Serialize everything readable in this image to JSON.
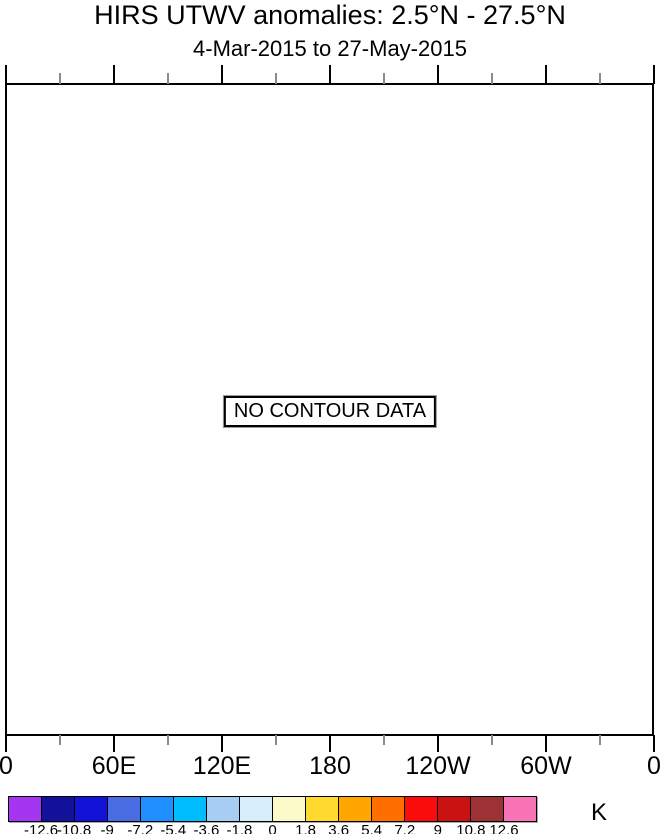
{
  "chart_data": {
    "type": "heatmap",
    "title": "HIRS UTWV anomalies: 2.5°N - 27.5°N",
    "subtitle": "4-Mar-2015 to 27-May-2015",
    "status_message": "NO CONTOUR DATA",
    "values": [],
    "x_axis": {
      "tick_labels": [
        "0",
        "60E",
        "120E",
        "180",
        "120W",
        "60W",
        "0"
      ],
      "major_tick_fractions": [
        0,
        0.16667,
        0.33333,
        0.5,
        0.66667,
        0.83333,
        1
      ],
      "minor_tick_fractions": [
        0.08333,
        0.25,
        0.41667,
        0.58333,
        0.75,
        0.91667
      ]
    },
    "colorbar": {
      "unit": "K",
      "boundary_labels": [
        "-12.6",
        "-10.8",
        "-9",
        "-7.2",
        "-5.4",
        "-3.6",
        "-1.8",
        "0",
        "1.8",
        "3.6",
        "5.4",
        "7.2",
        "9",
        "10.8",
        "12.6"
      ],
      "cell_colors": [
        "#a435f0",
        "#13109c",
        "#1312d9",
        "#4a6ce3",
        "#1f8eff",
        "#00bdff",
        "#a6cef5",
        "#d9eefb",
        "#fbfbc9",
        "#ffd92d",
        "#ffa600",
        "#ff6f00",
        "#fb0c0c",
        "#ca1212",
        "#9e3134",
        "#f973b7"
      ]
    },
    "colors": {
      "axis": "#000000",
      "minor_tick": "#8a8a8a"
    }
  }
}
